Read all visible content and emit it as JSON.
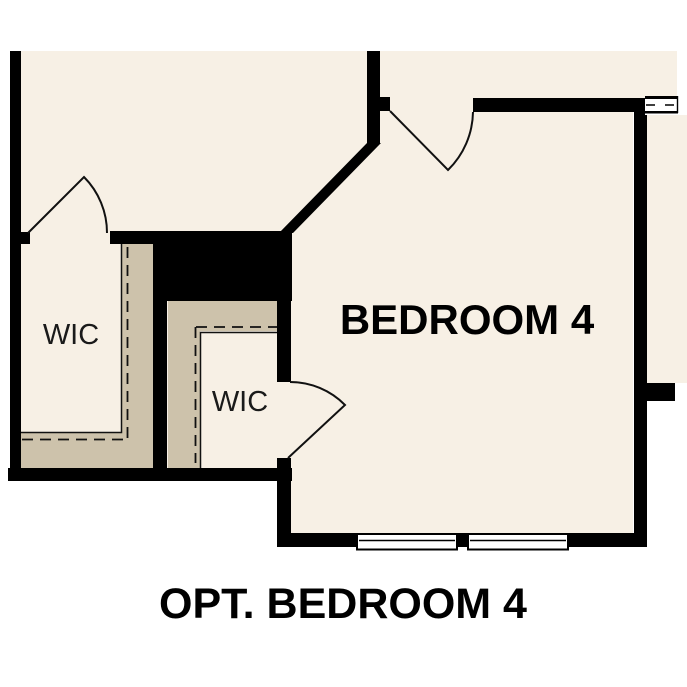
{
  "plan": {
    "rooms": {
      "wic_left": {
        "label": "WIC"
      },
      "wic_right": {
        "label": "WIC"
      },
      "bedroom4": {
        "label": "BEDROOM 4"
      }
    },
    "caption": "OPT. BEDROOM 4",
    "colors": {
      "page": "#ffffff",
      "floor": "#f7f0e5",
      "shelving": "#cdc2ab",
      "wall": "#000000"
    }
  }
}
